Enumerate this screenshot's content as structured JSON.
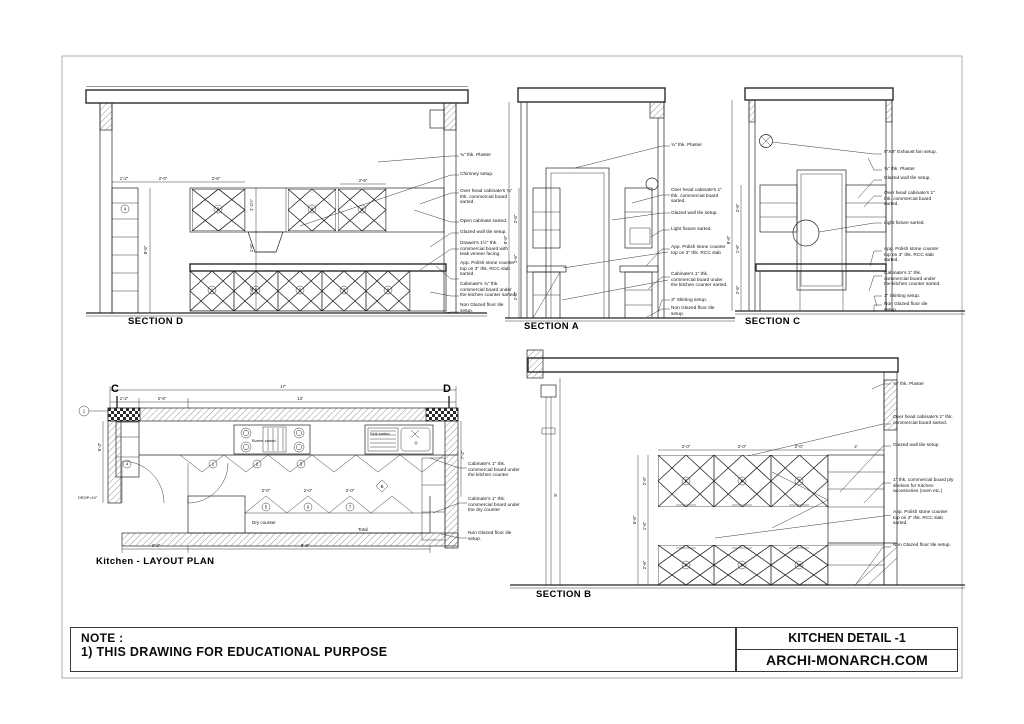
{
  "sheet": {
    "note_heading": "NOTE :",
    "note_line1": "1) THIS DRAWING FOR EDUCATIONAL PURPOSE",
    "title": "KITCHEN DETAIL -1",
    "website": "ARCHI-MONARCH.COM",
    "line_color": "#242424"
  },
  "sectionD": {
    "title": "SECTION D",
    "annotations": [
      "¾\" thk. Plaster",
      "Chimney setup.",
      "Over head cabinate's ¾\" thk. commercial board sarted.",
      "Open cabinate sarted.",
      "Glazed wall tile setup.",
      "Drawer's 1½\" thk. commercial board with teak veneer facing.",
      "App. Polish stone counter top on 3\" thk. RCC slab sarted.",
      "Cabinate's ¾\" thk. commercial board under the kitchen counter sarted.",
      "Non Glazed floor tile setup."
    ],
    "dims": [
      "1'-2\"",
      "2'-0\"",
      "2'-6\"",
      "2'-6\"",
      "8'-6\"",
      "1'-1½\"",
      "1'-6\"",
      "2'-6\""
    ],
    "numbers": [
      "4",
      "3",
      "2",
      "4",
      "1",
      "5",
      "6",
      "7",
      "8"
    ]
  },
  "sectionA": {
    "title": "SECTION A",
    "annotations": [
      "¾\" thk. Plaster",
      "Over head cabinate's 1\" thk. commercial board sarted.",
      "Glazed wall tile setup.",
      "Light fixture sarted.",
      "App. Polish stone counter top on 3\" thk. RCC slab",
      "Cabinate's 1\" thk. commercial board under the kitchen counter sarted.",
      "3\" Skirting setup.",
      "Non Glazed floor tile setup."
    ],
    "dims": [
      "2'-6\"",
      "1'-6\"",
      "2'-6\"",
      "8'-6\""
    ]
  },
  "sectionC": {
    "title": "SECTION C",
    "annotations": [
      "9\"X9\" Exhaust fan setup.",
      "¾\" thk. Plaster",
      "Glazed wall tile setup.",
      "Over head cabinate's 1\" thk. commercial board sarted.",
      "Light fixture sarted.",
      "App. Polish stone counter top on 3\" thk. RCC slab sarted.",
      "Cabinate's 1\" thk. commercial board under the kitchen counter sarted.",
      "3\" Skirting setup.",
      "Non Glazed floor tile setup."
    ],
    "dims": [
      "2'-6\"",
      "1'-6\"",
      "2'-6\"",
      "8'-6\""
    ]
  },
  "sectionB": {
    "title": "SECTION B",
    "annotations": [
      "¾\" thk. Plaster",
      "Over head cabinate's 1\" thk. commercial board sarted.",
      "Glazed wall tile setup.",
      "1\" thk. commercial board ply shelves for Kitchen accessories (oven etc.)",
      "App. Polish stone counter top on 3\" thk. RCC slab sarted.",
      "Non Glazed floor tile setup."
    ],
    "dims": [
      "2'-0\"",
      "2'-0\"",
      "2'-0\"",
      "2'",
      "2'-6\"",
      "1'-6\"",
      "2'-6\"",
      "6'-6\"",
      "8'"
    ],
    "numbers": [
      "5",
      "6",
      "7",
      "8",
      "9",
      "10"
    ]
  },
  "plan": {
    "title": "Kitchen - LAYOUT PLAN",
    "annotations": [
      "Cabinate's 1\" thk. commercial board under the kitchen counter",
      "Cabinate's 1\" thk. commercial board under the dry counter",
      "Non Glazed floor tile setup."
    ],
    "labels": {
      "dry_counter": "Dry counter",
      "total": "Total",
      "drop": "DROP=10\"",
      "sink": "Sink sarted.",
      "burner": "Burner sarted."
    },
    "markers": {
      "c": "C",
      "d": "D",
      "grid": "1",
      "cut_b": "B"
    },
    "dims": [
      "17'",
      "1'-2\"",
      "2'-6\"",
      "13'",
      "3'-2\"",
      "8'-8\"",
      "5'-3\"",
      "7'-2\"",
      "2'-0\"",
      "2'-0\"",
      "2'-0\""
    ],
    "numbers": [
      "4",
      "1",
      "2",
      "3",
      "5",
      "6",
      "7"
    ]
  }
}
